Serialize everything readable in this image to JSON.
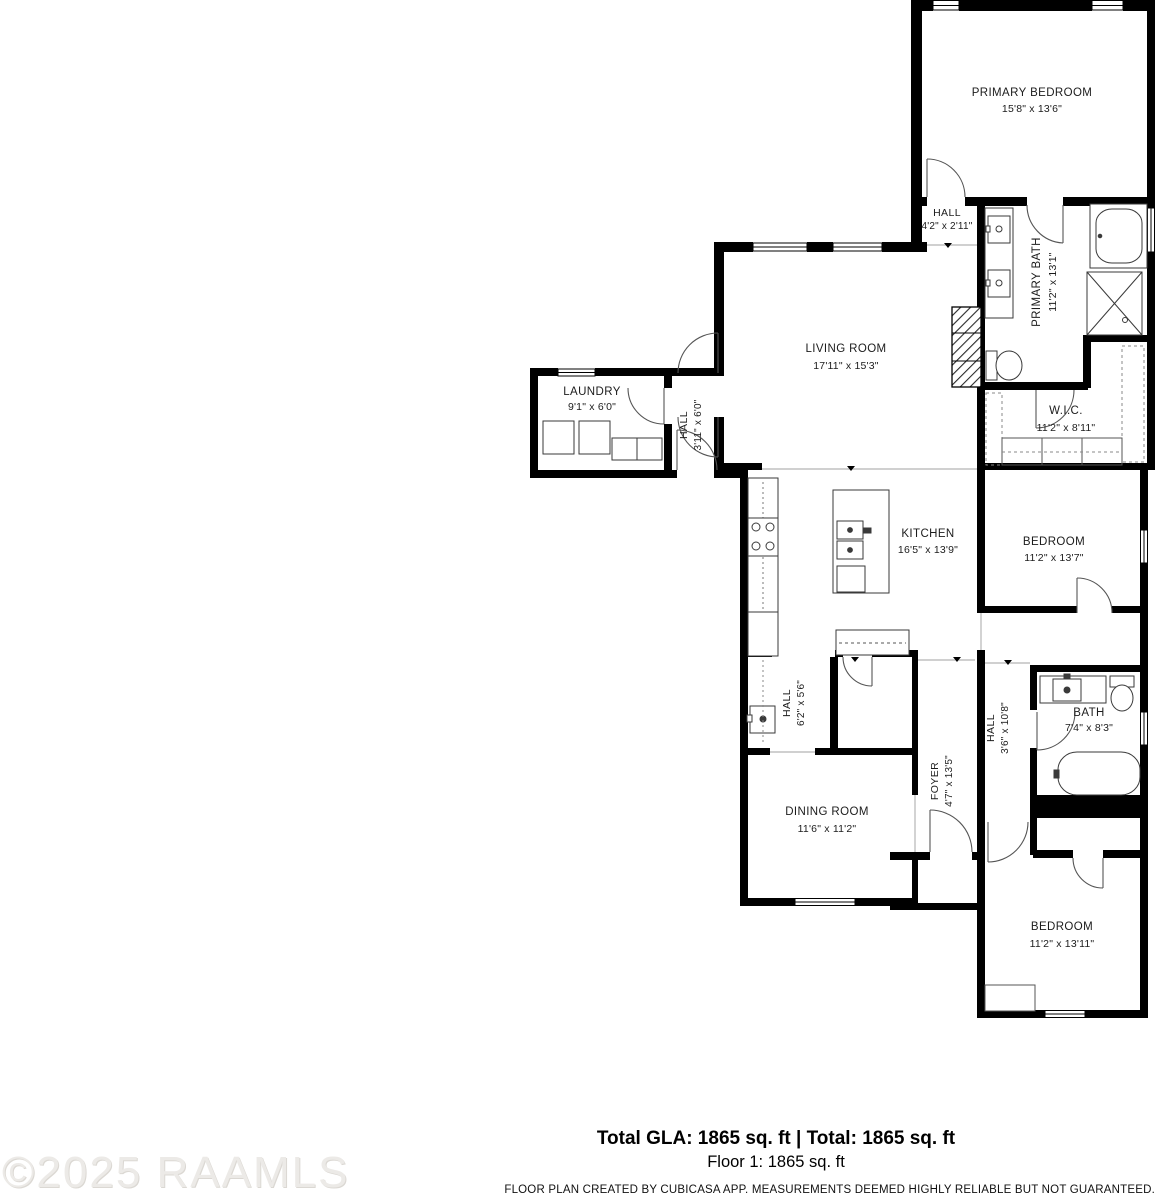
{
  "watermark": "©2025 RAAMLS",
  "footer": {
    "totals": "Total GLA: 1865 sq. ft | Total: 1865 sq. ft",
    "floor": "Floor 1: 1865 sq. ft",
    "disclaimer": "FLOOR PLAN CREATED BY CUBICASA APP. MEASUREMENTS DEEMED HIGHLY RELIABLE BUT NOT GUARANTEED."
  },
  "rooms": {
    "primary_bedroom": {
      "name": "PRIMARY BEDROOM",
      "dims": "15'8\" x 13'6\""
    },
    "hall_upper": {
      "name": "HALL",
      "dims": "4'2\" x 2'11\""
    },
    "primary_bath": {
      "name": "PRIMARY BATH",
      "dims": "11'2\" x 13'1\""
    },
    "living_room": {
      "name": "LIVING ROOM",
      "dims": "17'11\" x 15'3\""
    },
    "laundry": {
      "name": "LAUNDRY",
      "dims": "9'1\" x 6'0\""
    },
    "hall_laundry": {
      "name": "HALL",
      "dims": "3'11\" x 6'0\""
    },
    "wic": {
      "name": "W.I.C.",
      "dims": "11'2\" x 8'11\""
    },
    "kitchen": {
      "name": "KITCHEN",
      "dims": "16'5\" x 13'9\""
    },
    "bedroom_mid": {
      "name": "BEDROOM",
      "dims": "11'2\" x 13'7\""
    },
    "hall_kitchen": {
      "name": "HALL",
      "dims": "6'2\" x 5'6\""
    },
    "hall_lower": {
      "name": "HALL",
      "dims": "3'6\" x 10'8\""
    },
    "bath": {
      "name": "BATH",
      "dims": "7'4\" x 8'3\""
    },
    "dining_room": {
      "name": "DINING ROOM",
      "dims": "11'6\" x 11'2\""
    },
    "foyer": {
      "name": "FOYER",
      "dims": "4'7\" x 13'5\""
    },
    "bedroom_bottom": {
      "name": "BEDROOM",
      "dims": "11'2\" x 13'11\""
    }
  }
}
